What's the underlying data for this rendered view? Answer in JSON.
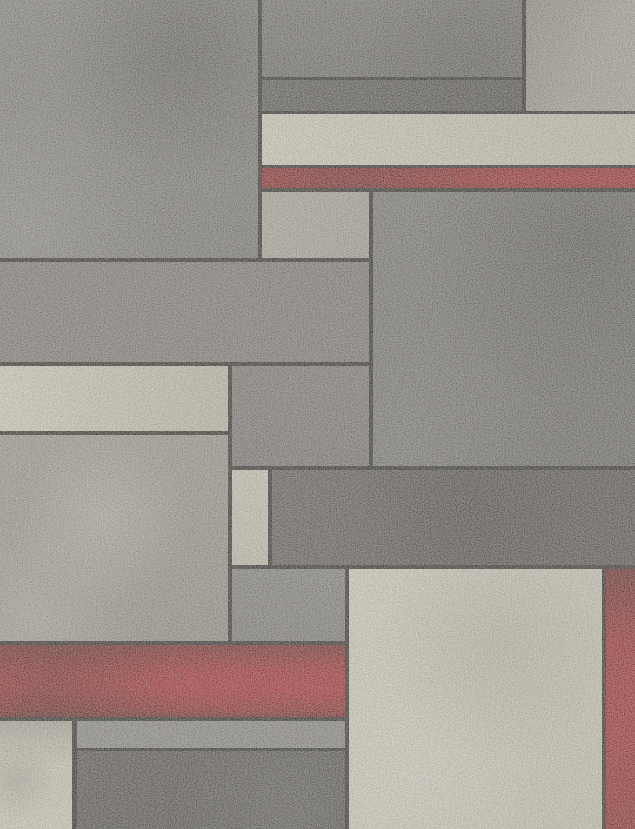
{
  "scene": {
    "type": "abstract-geometric-rug-pattern",
    "style": "mondrian-color-block",
    "texture": "dithered woven fabric speckle"
  },
  "canvas": {
    "width": 635,
    "height": 829,
    "line_color": "#171513"
  },
  "palette": {
    "line_black": "#171513",
    "gray_medium": "#7b7977",
    "gray_dark": "#5e5c5a",
    "gray_darker": "#4a4745",
    "gray_light_speckled": "#a8a59a",
    "cream": "#e2e0cc",
    "red": "#a11217",
    "red_dark": "#6f0f10"
  },
  "blocks": [
    {
      "name": "block-top-left-gray",
      "x": 0,
      "y": 0,
      "w": 258,
      "h": 258,
      "bg": "radial-gradient(circle at 70% 20%, rgba(38,36,34,0.38), rgba(38,36,34,0) 48%), radial-gradient(circle at 10% 88%, rgba(196,194,190,0.28), rgba(196,194,190,0) 42%), linear-gradient(135deg, #848280, #747270)"
    },
    {
      "name": "block-top-mid-gray",
      "x": 262,
      "y": 0,
      "w": 260,
      "h": 77,
      "bg": "radial-gradient(circle at 80% 80%, rgba(30,28,26,0.22), rgba(30,28,26,0) 55%), linear-gradient(180deg, #716f6d, #676563)"
    },
    {
      "name": "block-top-mid-dark-band",
      "x": 262,
      "y": 80,
      "w": 260,
      "h": 31,
      "bg": "linear-gradient(90deg, #514f4d, #454341)"
    },
    {
      "name": "block-top-right-light",
      "x": 526,
      "y": 0,
      "w": 109,
      "h": 111,
      "bg": "linear-gradient(115deg, #8d8b81, #a9a799 55%, #b1afa1)"
    },
    {
      "name": "block-cream-band",
      "x": 262,
      "y": 114,
      "w": 373,
      "h": 51,
      "bg": "linear-gradient(90deg, #e7e5d1, #dedcc8 45%, #cfccb9)"
    },
    {
      "name": "block-red-band",
      "x": 262,
      "y": 168,
      "w": 373,
      "h": 20,
      "bg": "radial-gradient(circle at 25% 40%, rgba(40,8,8,0.35), rgba(40,8,8,0) 55%), linear-gradient(180deg, #8d1013, #a61217 55%, #8c0f13)"
    },
    {
      "name": "block-mid-upper-light",
      "x": 262,
      "y": 192,
      "w": 107,
      "h": 66,
      "bg": "linear-gradient(115deg, #b8b5a7, #aba89a)"
    },
    {
      "name": "block-large-dark",
      "x": 373,
      "y": 192,
      "w": 262,
      "h": 274,
      "bg": "radial-gradient(circle at 82% 18%, rgba(28,26,24,0.34), rgba(28,26,24,0) 55%), radial-gradient(circle at 12% 96%, rgba(198,196,188,0.16), rgba(198,196,188,0) 42%), linear-gradient(150deg, #787673, #605e5a)"
    },
    {
      "name": "block-left-gray-band",
      "x": 0,
      "y": 262,
      "w": 369,
      "h": 100,
      "bg": "linear-gradient(90deg, #7e7a77, #797673)"
    },
    {
      "name": "block-left-cream",
      "x": 0,
      "y": 366,
      "w": 228,
      "h": 65,
      "bg": "linear-gradient(90deg, #ece9d7, #dcdac6 45%, #cbc9b5)"
    },
    {
      "name": "block-mid-gray",
      "x": 232,
      "y": 366,
      "w": 137,
      "h": 100,
      "bg": "linear-gradient(180deg, #7b7774, #737070)"
    },
    {
      "name": "block-left-light",
      "x": 0,
      "y": 435,
      "w": 228,
      "h": 206,
      "bg": "radial-gradient(circle at 45% 40%, rgba(236,234,220,0.35), rgba(236,234,220,0) 50%), radial-gradient(circle at 15% 90%, rgba(236,234,220,0.30), rgba(236,234,220,0) 40%), linear-gradient(160deg, #a3a094, #949186)"
    },
    {
      "name": "block-cream-column",
      "x": 232,
      "y": 470,
      "w": 36,
      "h": 95,
      "bg": "linear-gradient(180deg, #dedcc8, #d2d0bc)"
    },
    {
      "name": "block-dark-slate-band",
      "x": 272,
      "y": 470,
      "w": 363,
      "h": 95,
      "bg": "radial-gradient(circle at 55% 45%, rgba(24,22,20,0.28), rgba(24,22,20,0) 60%), linear-gradient(90deg, #56534f, #484542)"
    },
    {
      "name": "block-mid-gray-2",
      "x": 232,
      "y": 569,
      "w": 113,
      "h": 72,
      "bg": "linear-gradient(180deg, #83817e, #7b7976)"
    },
    {
      "name": "block-red-band-2",
      "x": 0,
      "y": 645,
      "w": 345,
      "h": 72,
      "bg": "radial-gradient(circle at 15% 80%, rgba(35,6,6,0.38), rgba(35,6,6,0) 45%), linear-gradient(180deg, #6f0f10, #a91218 38%, #b4131b 58%, #8e1013 90%, #670d0e)"
    },
    {
      "name": "block-bottom-left-cream",
      "x": 0,
      "y": 721,
      "w": 72,
      "h": 108,
      "bg": "radial-gradient(circle at 25% 55%, rgba(142,140,130,0.38), rgba(142,140,130,0) 48%), linear-gradient(180deg, #b4b2a3, #dfddca 40%, #e4e2cf)"
    },
    {
      "name": "block-bottom-gray-sliver",
      "x": 77,
      "y": 721,
      "w": 268,
      "h": 27,
      "bg": "linear-gradient(90deg, #8d8b89, #878583)"
    },
    {
      "name": "block-bottom-dark",
      "x": 77,
      "y": 751,
      "w": 268,
      "h": 78,
      "bg": "radial-gradient(circle at 80% 75%, rgba(134,132,128,0.28), rgba(134,132,128,0) 55%), linear-gradient(135deg, #4c4947, #3d3b39)"
    },
    {
      "name": "block-bottom-cream-large",
      "x": 349,
      "y": 569,
      "w": 253,
      "h": 260,
      "bg": "radial-gradient(circle at 60% 28%, rgba(150,148,136,0.30), rgba(150,148,136,0) 50%), radial-gradient(circle at 22% 78%, rgba(246,244,232,0.45), rgba(246,244,232,0) 45%), linear-gradient(120deg, #eae8d5, #d8d6c2)"
    },
    {
      "name": "block-right-red-stripe",
      "x": 606,
      "y": 569,
      "w": 29,
      "h": 260,
      "bg": "linear-gradient(180deg, #5e0d0e, #9c1115 28%, #a61218 60%, #8c0f13)"
    }
  ]
}
